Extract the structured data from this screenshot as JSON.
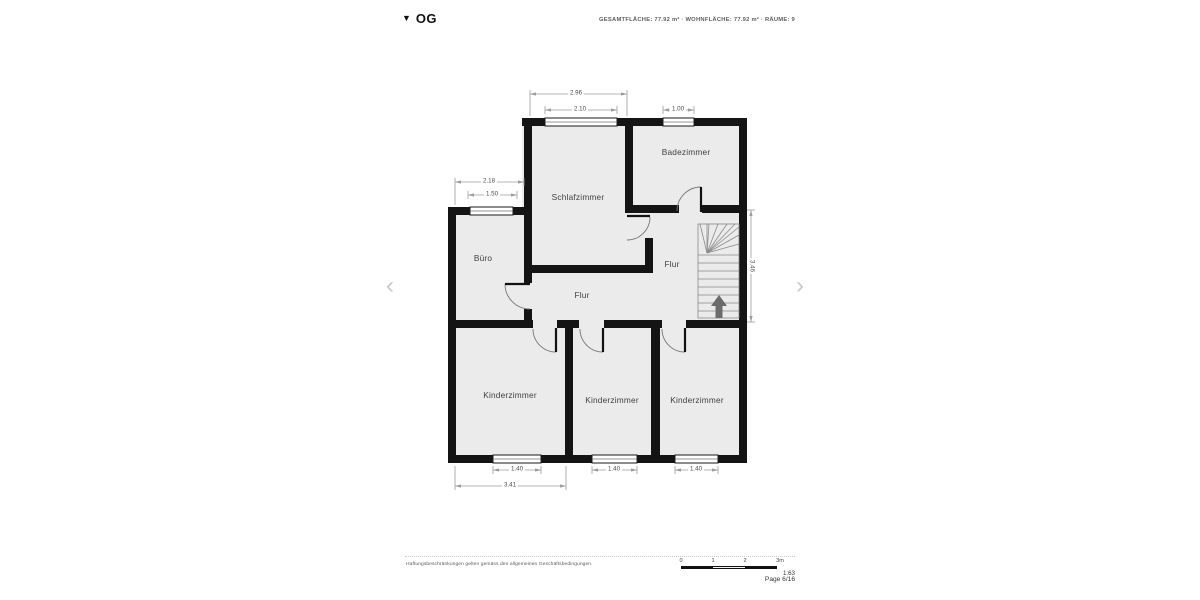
{
  "header": {
    "floor_marker": "▼",
    "floor_label": "OG",
    "area_summary": "GESAMTFLÄCHE: 77.92 m² · WOHNFLÄCHE: 77.92 m² · RÄUME: 9"
  },
  "navigation": {
    "prev_symbol": "‹",
    "next_symbol": "›"
  },
  "rooms": {
    "badezimmer": "Badezimmer",
    "schlafzimmer": "Schlafzimmer",
    "buero": "Büro",
    "flur_upper": "Flur",
    "flur_lower": "Flur",
    "kinderzimmer_left": "Kinderzimmer",
    "kinderzimmer_middle": "Kinderzimmer",
    "kinderzimmer_right": "Kinderzimmer"
  },
  "dimensions": {
    "schlafzimmer_width": "2.96",
    "schlafzimmer_window": "2.10",
    "badezimmer_window": "1.00",
    "buero_width": "2.18",
    "buero_window": "1.50",
    "flur_height": "3.46",
    "kinderzimmer_left_window": "1.40",
    "kinderzimmer_middle_window": "1.40",
    "kinderzimmer_right_window": "1.40",
    "kinderzimmer_left_width": "3.41"
  },
  "footer": {
    "disclaimer": "Haftungsbeschränkungen gelten gemäss den allgemeinen Geschäftsbedingungen.",
    "scale_ticks": [
      "0",
      "1",
      "2",
      "3m"
    ],
    "scale_ratio": "1:63",
    "page_label": "Page 6/16"
  },
  "colors": {
    "wall": "#141414",
    "room_fill": "#ebebeb",
    "dimension_line": "#9b9b9b",
    "label_text": "#3f3f3f",
    "nav_chevron": "#c8c8c8"
  }
}
